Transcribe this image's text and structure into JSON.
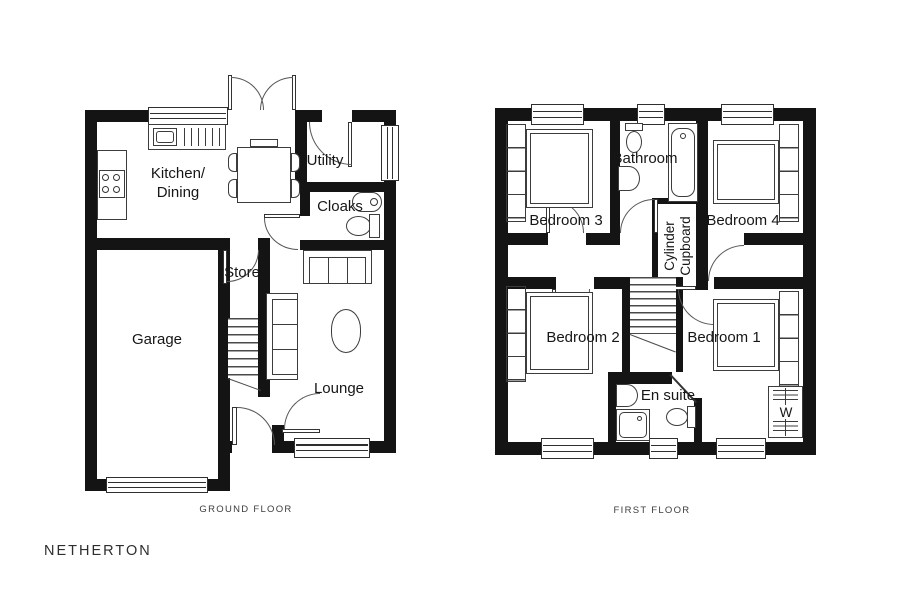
{
  "plan": {
    "title": "NETHERTON",
    "colors": {
      "wall": "#141414",
      "line": "#3c3c3c",
      "text": "#161616",
      "background": "#ffffff"
    },
    "ground_floor": {
      "caption": "GROUND FLOOR",
      "rooms": {
        "kitchen_dining_line1": "Kitchen/",
        "kitchen_dining_line2": "Dining",
        "utility": "Utility",
        "cloaks": "Cloaks",
        "store": "Store",
        "garage": "Garage",
        "lounge": "Lounge"
      }
    },
    "first_floor": {
      "caption": "FIRST FLOOR",
      "rooms": {
        "bathroom": "Bathroom",
        "bedroom3": "Bedroom 3",
        "bedroom4": "Bedroom 4",
        "cylinder_cupboard_line1": "Cylinder",
        "cylinder_cupboard_line2": "Cupboard",
        "bedroom2": "Bedroom 2",
        "bedroom1": "Bedroom 1",
        "en_suite": "En suite",
        "wardrobe": "W"
      }
    }
  }
}
